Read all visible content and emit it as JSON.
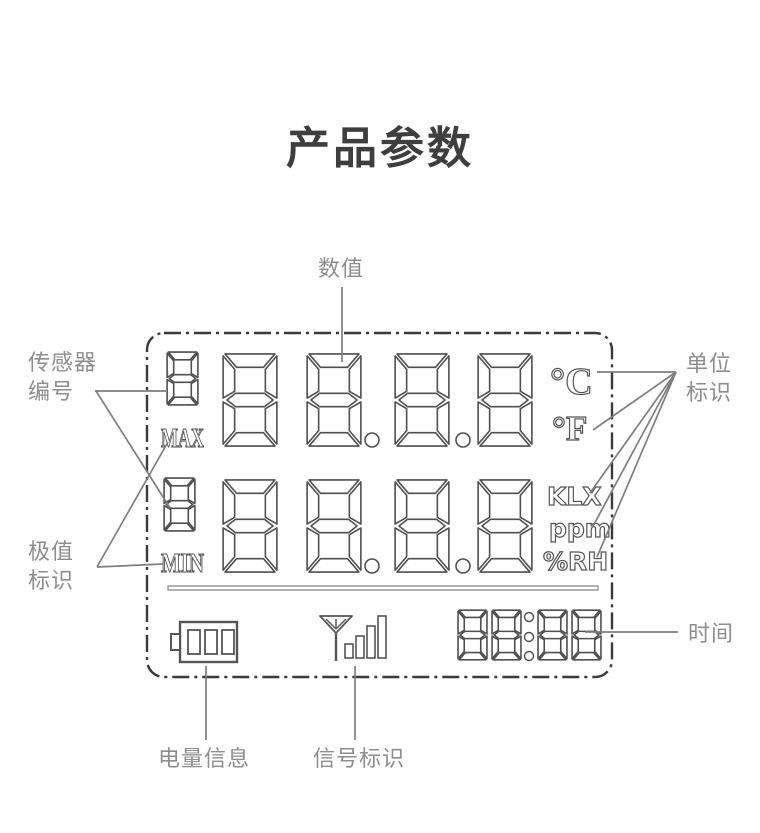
{
  "title": "产品参数",
  "annotations": {
    "value_label": "数值",
    "sensor_id_label": "传感器\n编号",
    "extreme_label": "极值\n标识",
    "unit_label": "单位\n标识",
    "time_label": "时间",
    "battery_label": "电量信息",
    "signal_label": "信号标识"
  },
  "lcd": {
    "row_max": {
      "sensor_digit": "8",
      "indicator": "MAX",
      "value": "88.8.8"
    },
    "row_min": {
      "sensor_digit": "8",
      "indicator": "MIN",
      "value": "88.8.8"
    },
    "units": {
      "celsius": "°C",
      "fahrenheit": "°F",
      "lux": "KLX",
      "ppm": "ppm",
      "humidity": "%RH"
    },
    "clock": "88:88",
    "icons": {
      "battery": "battery-outline-3-cells",
      "signal": "antenna-with-4-bars"
    }
  },
  "colors": {
    "title": "#3e3e3e",
    "annotation_text": "#8d8d8d",
    "annotation_line": "#7e7e7e",
    "lcd_border": "#3a3a3a",
    "lcd_glyph": "#4f4f4f",
    "background": "#ffffff"
  }
}
